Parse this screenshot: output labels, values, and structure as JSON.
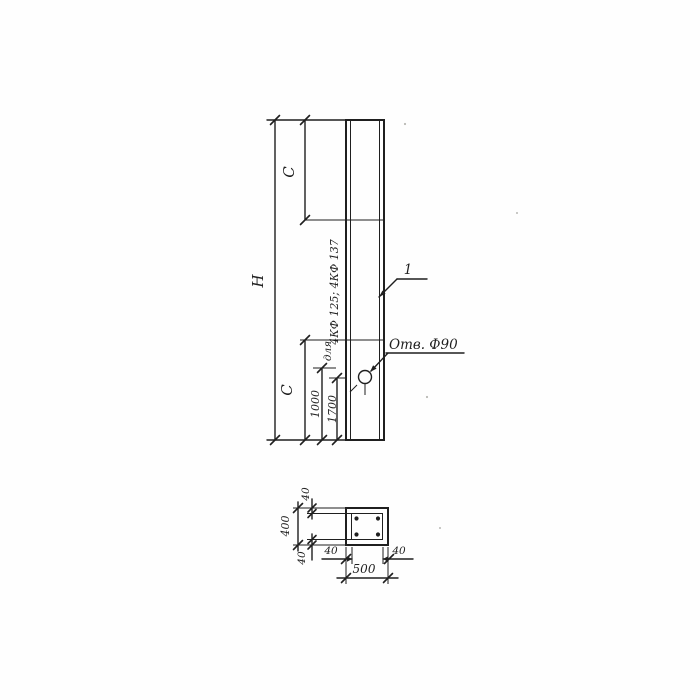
{
  "drawing": {
    "elevation": {
      "height_label": "H",
      "top_segment_label": "C",
      "bottom_segment_label": "C",
      "hole_offset_1": "1000",
      "hole_offset_2": "1700",
      "applicability_prefix": "для",
      "applicability_series": "4КФ 125; 4КФ 137",
      "part_callout": "1",
      "hole_callout": "Отв. Ф90"
    },
    "section": {
      "overall_width": "500",
      "overall_height": "400",
      "cover_top": "40",
      "cover_bottom": "40",
      "cover_left": "40",
      "cover_right": "40"
    },
    "colors": {
      "ink": "#1f1f1f",
      "paper": "#fefefe"
    }
  }
}
